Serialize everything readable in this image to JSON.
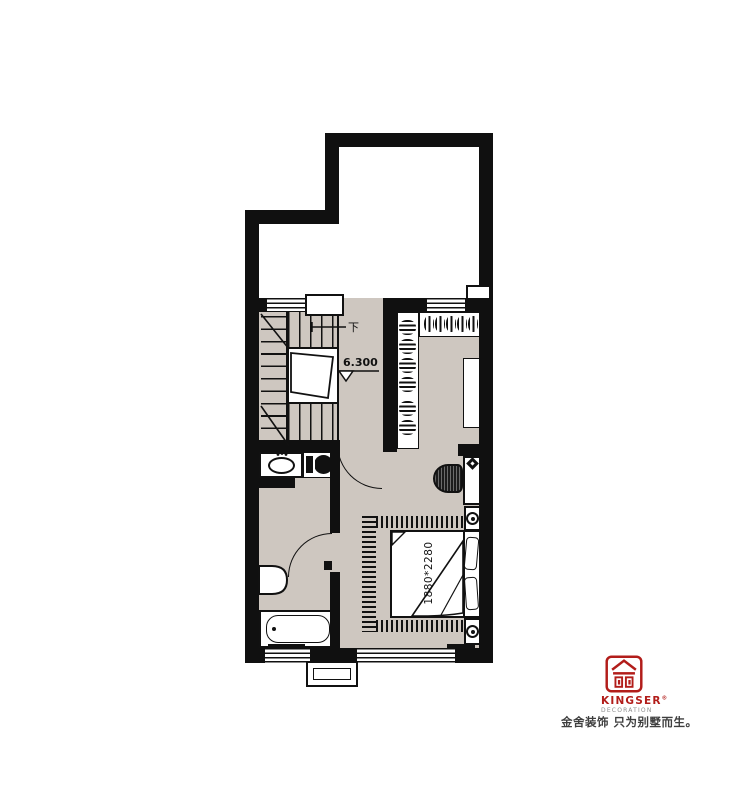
{
  "colors": {
    "wall": "#101010",
    "floor": "#cec7c0",
    "brand_red": "#b21d1a",
    "line": "#111111",
    "tagline_text": "#3f3f3f"
  },
  "plan": {
    "stairs": {
      "direction_label": "下",
      "elevation_label": "6.300"
    },
    "bedroom": {
      "bed_size_label": "1880*2280"
    }
  },
  "branding": {
    "name": "KINGSER",
    "registered_mark": "®",
    "subtitle": "DECORATION",
    "tagline": "金舍装饰 只为别墅而生。"
  }
}
